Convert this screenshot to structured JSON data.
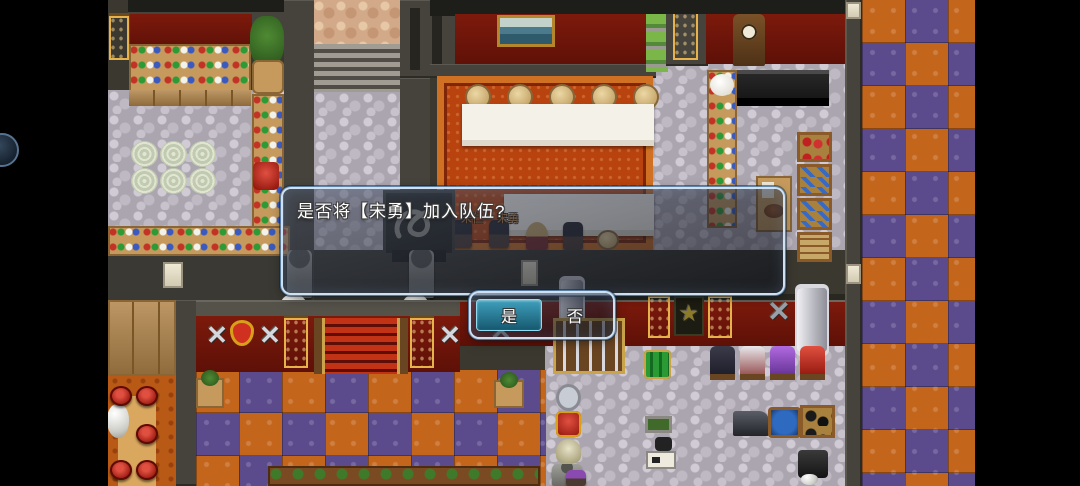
{
  "ui": {
    "dialogue": {
      "text": "是否将【宋勇】加入队伍?"
    },
    "choices": {
      "yes_label": "是",
      "no_label": "否",
      "selected": "是"
    }
  },
  "npc_labels": {
    "left": "宋仁",
    "right": "宋勇"
  },
  "icons": {
    "sword_glyph": "✕",
    "axe_glyph": "✕",
    "pentagram_glyph": "★"
  },
  "colors": {
    "window_border": "#cfe2f5",
    "selection_highlight": "#2f93b3",
    "checker_orange": "#c4651c",
    "checker_purple": "#5b4b8d",
    "wall_maroon": "#70150a",
    "carpet_orange": "#b8430f",
    "stone_floor": "#aba5af"
  }
}
